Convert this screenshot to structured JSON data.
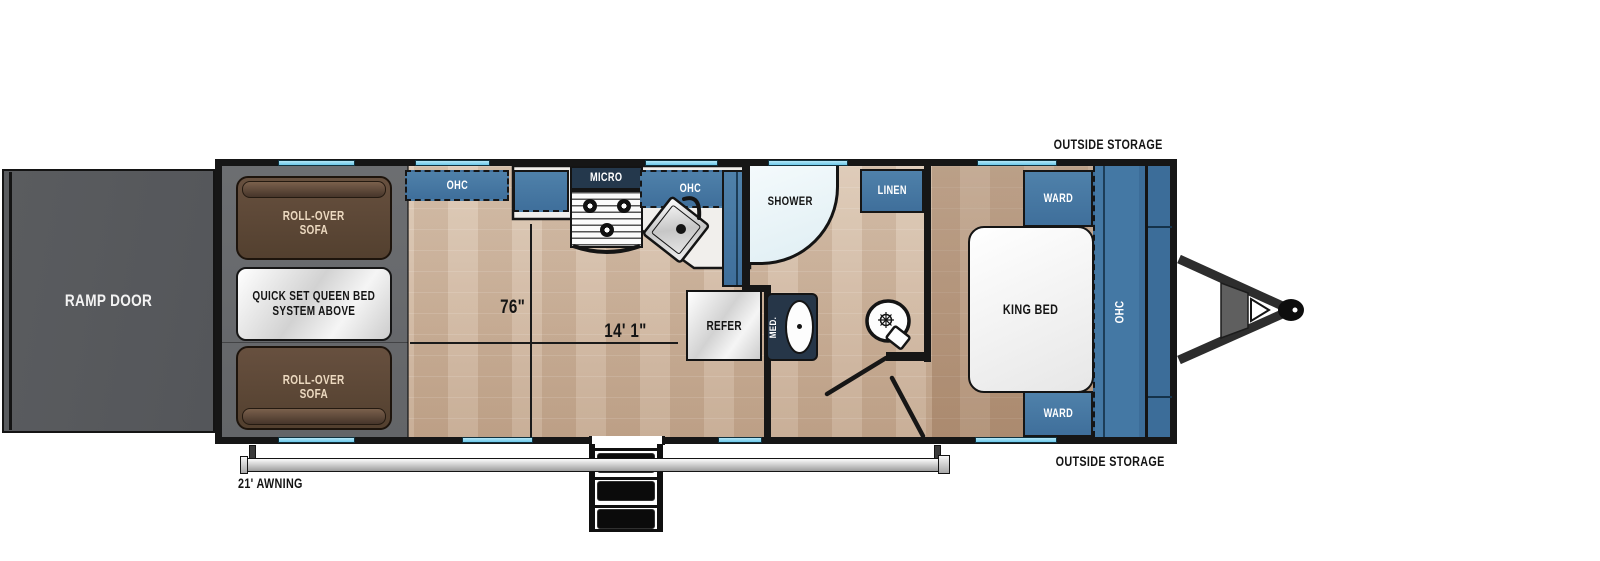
{
  "plan": {
    "ramp_door": "RAMP DOOR",
    "rollover_sofa_top": {
      "l1": "ROLL-OVER",
      "l2": "SOFA"
    },
    "rollover_sofa_bottom": {
      "l1": "ROLL-OVER",
      "l2": "SOFA"
    },
    "queen_bed_note": {
      "l1": "QUICK SET QUEEN BED",
      "l2": "SYSTEM ABOVE"
    },
    "kitchen": {
      "ohc_left": "OHC",
      "micro": "MICRO",
      "ohc_right": "OHC",
      "refer": "REFER"
    },
    "bath": {
      "shower": "SHOWER",
      "linen": "LINEN",
      "med": "MED."
    },
    "bedroom": {
      "ward_top": "WARD",
      "ward_bottom": "WARD",
      "king_bed": "KING BED",
      "ohc": "OHC"
    },
    "outside_storage_top": "OUTSIDE STORAGE",
    "outside_storage_bottom": "OUTSIDE STORAGE",
    "awning": "21' AWNING",
    "dimensions": {
      "interior_width": "76\"",
      "cargo_length": "14' 1\""
    }
  },
  "colors": {
    "cabinet_blue": "#4678a3",
    "cabinet_blue_dark": "#3c6d99",
    "micro_navy": "#24384c",
    "window_cyan": "#7bd2f0",
    "sofa_brown": "#5a4336",
    "wall_black": "#161616",
    "ramp_gray": "#56585b",
    "garage_gray": "#686a6d",
    "wood_light": "#d5c0ab",
    "wood_dark": "#b79a81",
    "counter_white": "#f1efec"
  }
}
